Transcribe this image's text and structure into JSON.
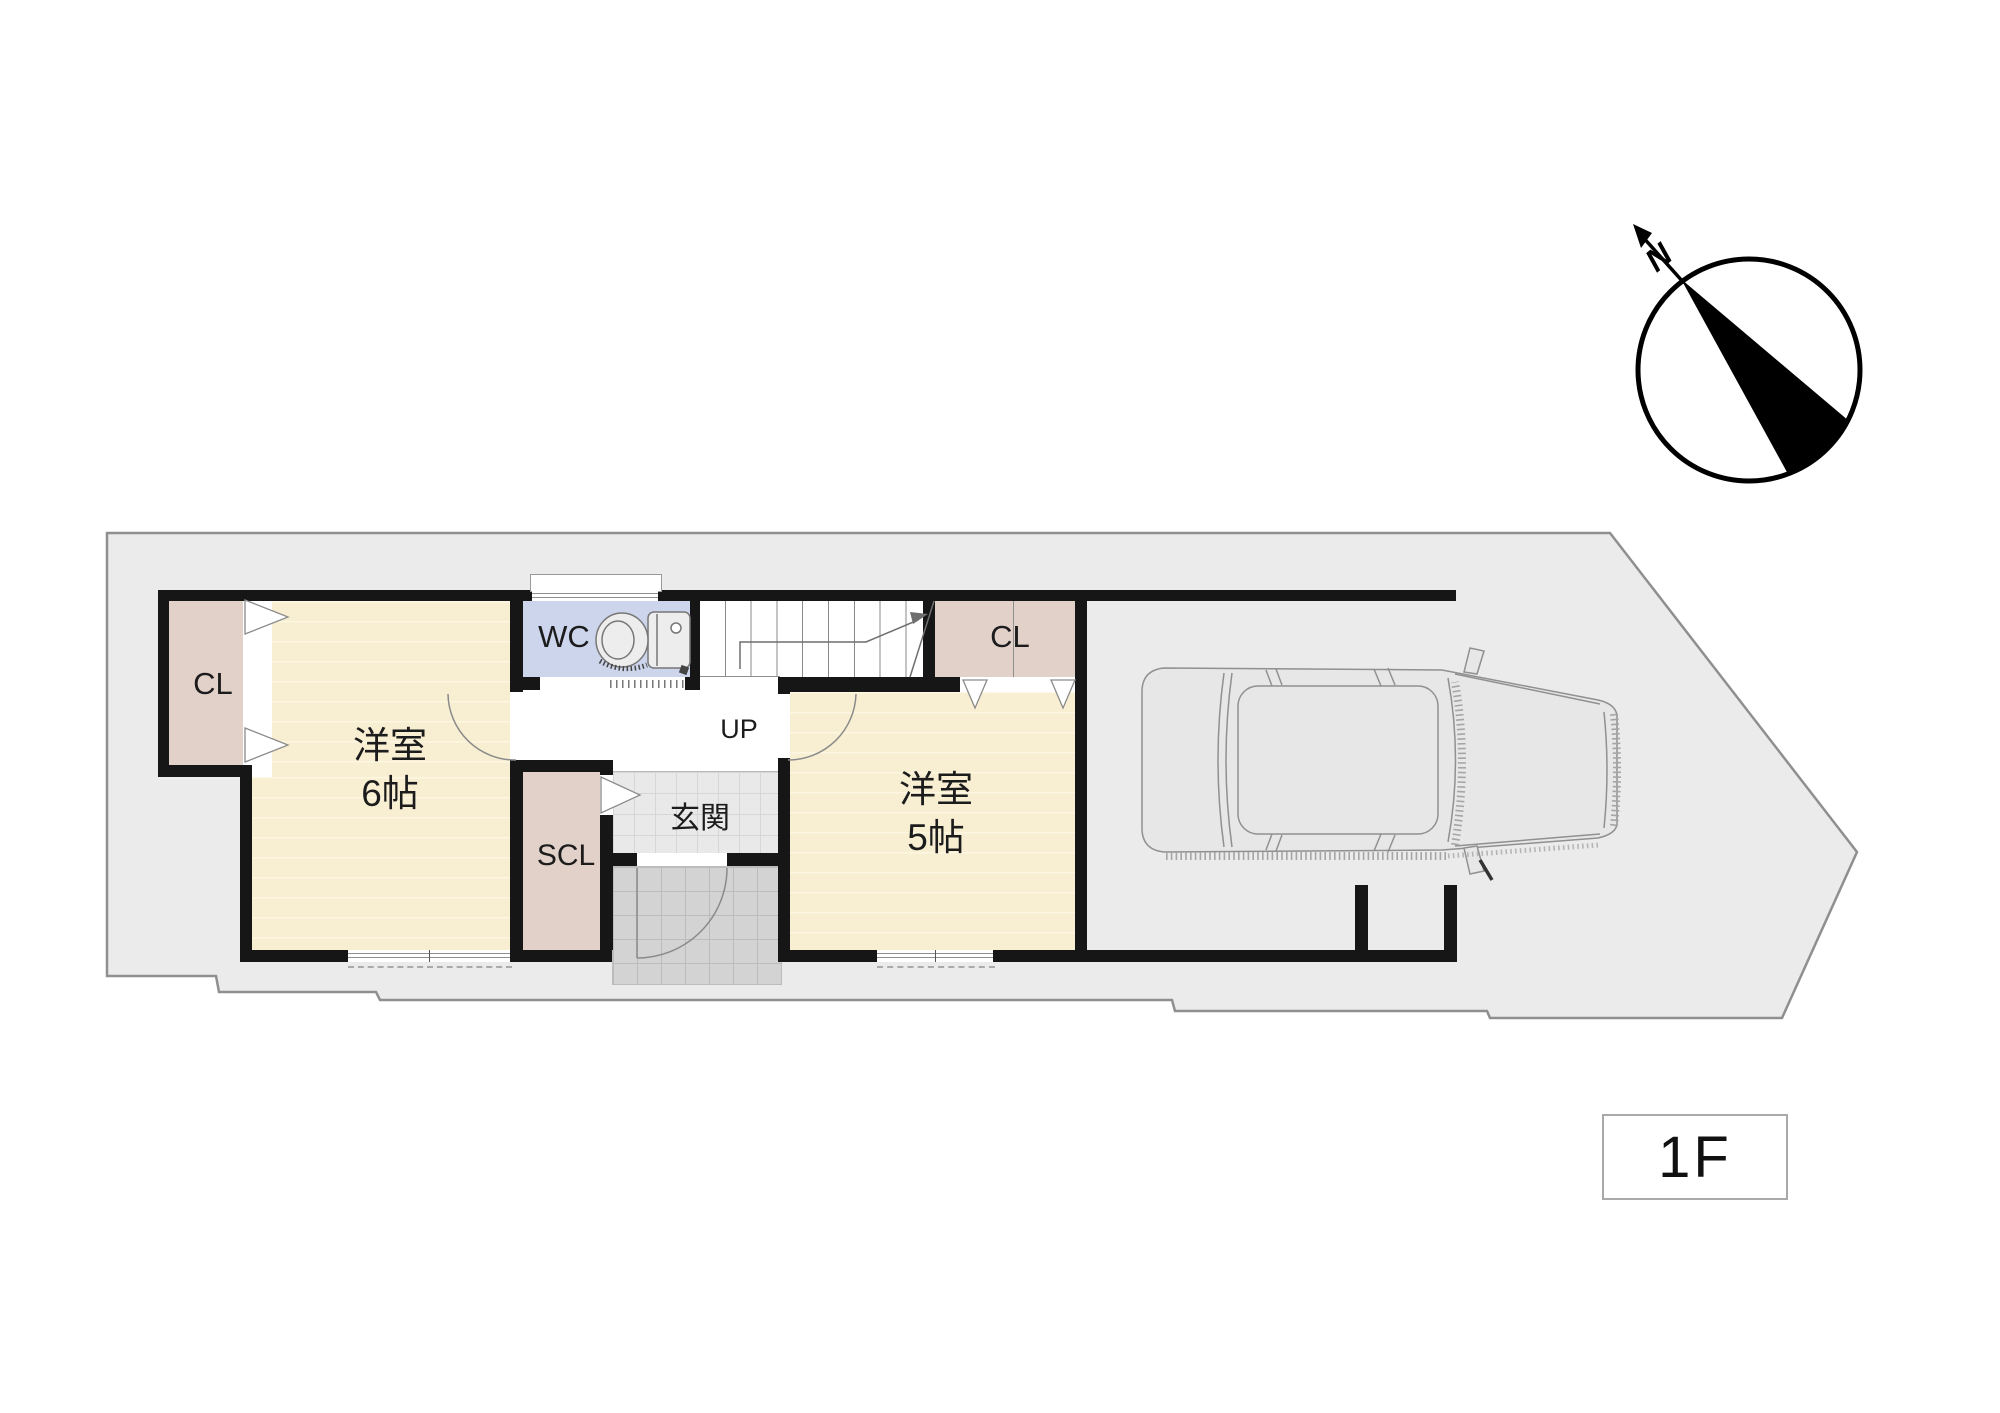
{
  "floor_badge": {
    "label": "1F"
  },
  "compass": {
    "north_label": "N"
  },
  "rooms": {
    "closet_left": {
      "label": "CL"
    },
    "western_room_6": {
      "label": "洋室",
      "size_label": "6帖"
    },
    "wc": {
      "label": "WC"
    },
    "stairs": {
      "direction_label": "UP"
    },
    "closet_right": {
      "label": "CL"
    },
    "western_room_5": {
      "label": "洋室",
      "size_label": "5帖"
    },
    "shoe_closet": {
      "label": "SCL"
    },
    "entrance": {
      "label": "玄関"
    }
  },
  "colors": {
    "wall": "#161616",
    "lot": "#ebebeb",
    "lot-border": "#8f8f8f",
    "room-cream": "#f8efd3",
    "room-stripe": "#fdf6e1",
    "closet-pink": "#e2d1c9",
    "wc-blue": "#ccd5ec",
    "genkan-tile": "#e9e9e9",
    "genkan-line": "#d6d6d6",
    "porch-tile": "#d3d3d3",
    "porch-line": "#bcbcbc",
    "outline-gray": "#8f8f8f",
    "text": "#1c1c1c"
  }
}
